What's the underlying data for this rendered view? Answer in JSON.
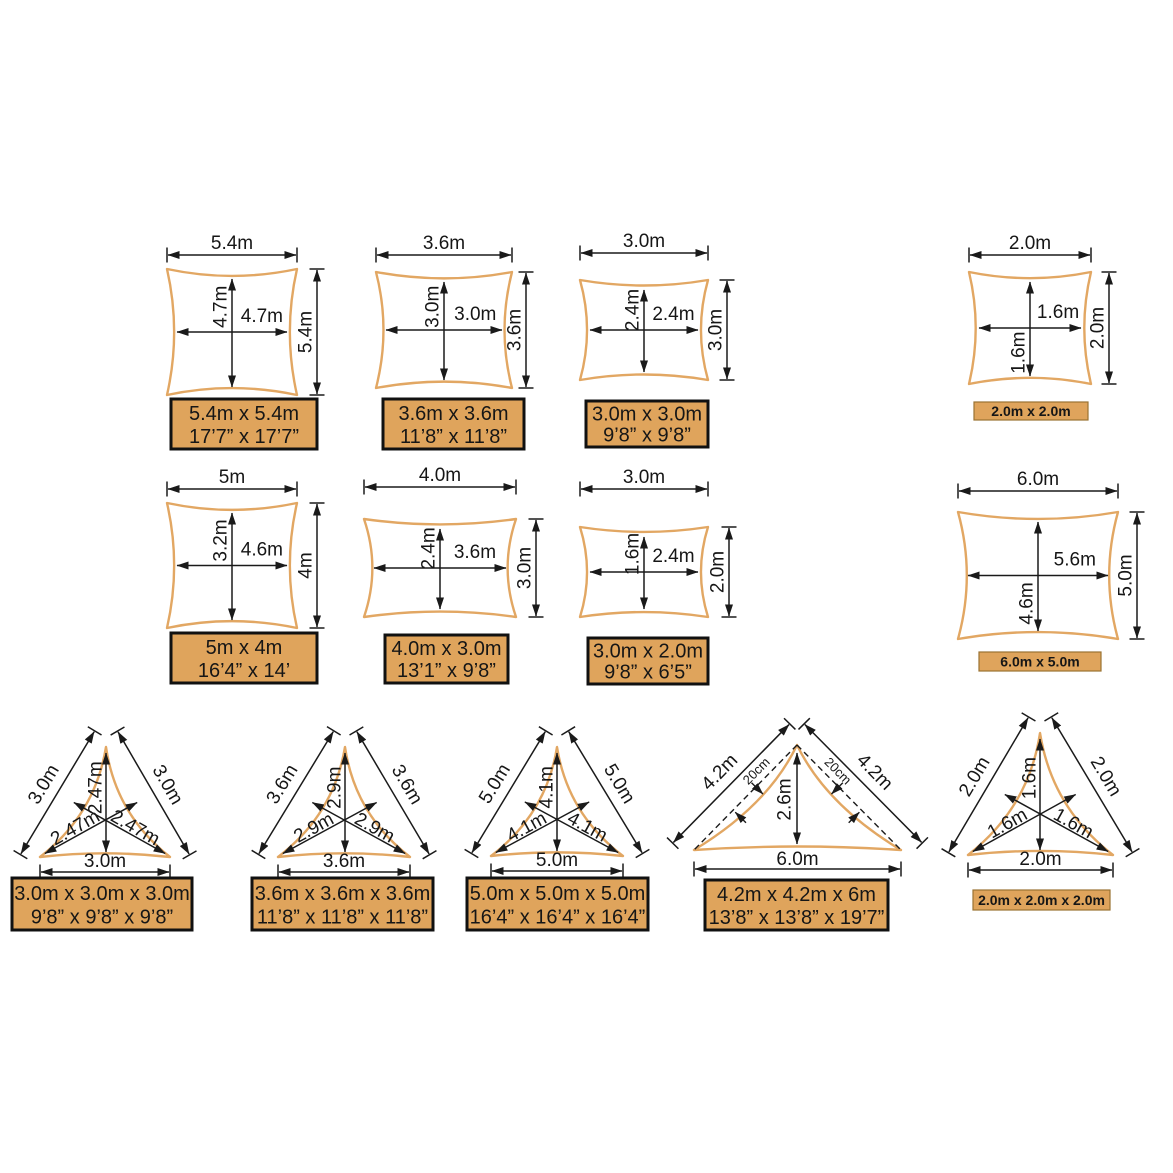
{
  "colors": {
    "sail_outline": "#E2A763",
    "label_fill": "#DFA45C",
    "label_border": "#111111",
    "small_label_border": "#9A7332",
    "line": "#1A1A1A",
    "text": "#161616",
    "background": "#FFFFFF"
  },
  "squares": [
    {
      "top": "5.4m",
      "side": "5.4m",
      "inner_h": "4.7m",
      "inner_w": "4.7m",
      "label1": "5.4m x 5.4m",
      "label2": "17’7” x 17’7”"
    },
    {
      "top": "3.6m",
      "side": "3.6m",
      "inner_h": "3.0m",
      "inner_w": "3.0m",
      "label1": "3.6m x 3.6m",
      "label2": "11’8” x 11’8”"
    },
    {
      "top": "3.0m",
      "side": "3.0m",
      "inner_h": "2.4m",
      "inner_w": "2.4m",
      "label1": "3.0m x 3.0m",
      "label2": "9’8” x 9’8”"
    },
    {
      "top": "2.0m",
      "side": "2.0m",
      "inner_h": "1.6m",
      "inner_w": "1.6m",
      "label1": "2.0m x 2.0m"
    }
  ],
  "rectangles": [
    {
      "top": "5m",
      "side": "4m",
      "inner_h": "3.2m",
      "inner_w": "4.6m",
      "label1": "5m x 4m",
      "label2": "16’4” x 14’"
    },
    {
      "top": "4.0m",
      "side": "3.0m",
      "inner_h": "2.4m",
      "inner_w": "3.6m",
      "label1": "4.0m x 3.0m",
      "label2": "13’1” x 9’8”"
    },
    {
      "top": "3.0m",
      "side": "2.0m",
      "inner_h": "1.6m",
      "inner_w": "2.4m",
      "label1": "3.0m x 2.0m",
      "label2": "9’8” x 6’5”"
    },
    {
      "top": "6.0m",
      "side": "5.0m",
      "inner_h": "4.6m",
      "inner_w": "5.6m",
      "label1": "6.0m x 5.0m"
    }
  ],
  "triangles": [
    {
      "left": "3.0m",
      "right": "3.0m",
      "bottom": "3.0m",
      "inner_v": "2.47m",
      "inner_l": "2.47m",
      "inner_r": "2.47m",
      "label1": "3.0m x 3.0m x 3.0m",
      "label2": "9’8” x 9’8” x 9’8”"
    },
    {
      "left": "3.6m",
      "right": "3.6m",
      "bottom": "3.6m",
      "inner_v": "2.9m",
      "inner_l": "2.9m",
      "inner_r": "2.9m",
      "label1": "3.6m x 3.6m x 3.6m",
      "label2": "11’8” x 11’8” x 11’8”"
    },
    {
      "left": "5.0m",
      "right": "5.0m",
      "bottom": "5.0m",
      "inner_v": "4.1m",
      "inner_l": "4.1m",
      "inner_r": "4.1m",
      "label1": "5.0m x 5.0m x 5.0m",
      "label2": "16’4” x 16’4” x 16’4”"
    },
    {
      "left": "4.2m",
      "right": "4.2m",
      "bottom": "6.0m",
      "height": "2.6m",
      "sag_left": "20cm",
      "sag_right": "20cm",
      "label1": "4.2m x 4.2m x 6m",
      "label2": "13’8” x 13’8” x 19’7”"
    },
    {
      "left": "2.0m",
      "right": "2.0m",
      "bottom": "2.0m",
      "inner_v": "1.6m",
      "inner_l": "1.6m",
      "inner_r": "1.6m",
      "label1": "2.0m x 2.0m x 2.0m"
    }
  ]
}
